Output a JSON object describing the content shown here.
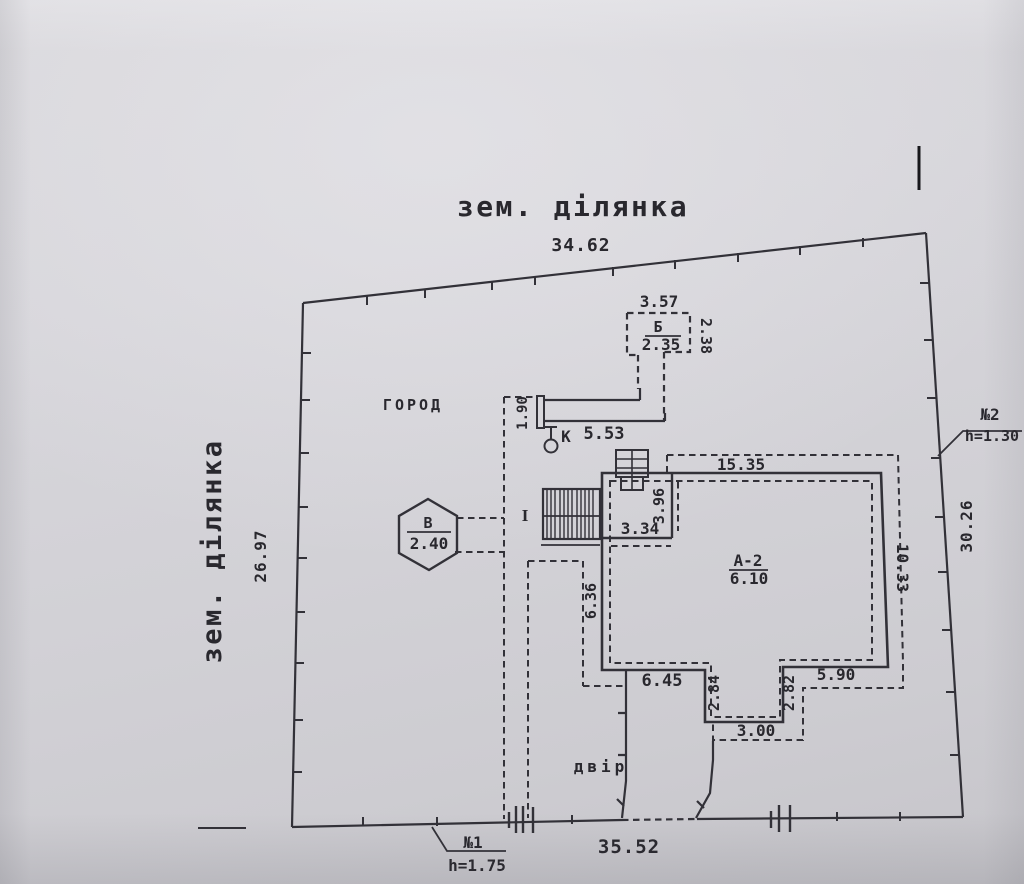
{
  "plot": {
    "title_top": "зем. ділянка",
    "title_left": "зем. ділянка",
    "dim_top": "34.62",
    "dim_left": "26.97",
    "dim_right": "30.26",
    "dim_bottom": "35.52"
  },
  "gates": {
    "no1_label": "№1",
    "no1_height": "h=1.75",
    "no2_label": "№2",
    "no2_height": "h=1.30"
  },
  "areas": {
    "garden": "ГОРОД",
    "yard": "двір"
  },
  "well": {
    "label": "К",
    "dim_length": "5.53",
    "dim_post": "1.90"
  },
  "outbuilding_b": {
    "label": "Б",
    "value": "2.35",
    "dim_width": "3.57",
    "dim_depth": "2.38"
  },
  "structure_v": {
    "label": "В",
    "value": "2.40"
  },
  "porch": {
    "label": "I"
  },
  "house_a": {
    "label": "А-2",
    "value": "6.10",
    "dim_top": "15.35",
    "dim_right": "10.33",
    "dim_left": "6.36",
    "dim_room_w": "3.34",
    "dim_room_h": "3.96",
    "dim_bottom_left": "6.45",
    "dim_notch_left": "2.84",
    "dim_notch_bottom": "3.00",
    "dim_notch_right": "2.82",
    "dim_bottom_right": "5.90"
  },
  "colors": {
    "ink": "#323138",
    "paper": "#d4d3d8"
  }
}
